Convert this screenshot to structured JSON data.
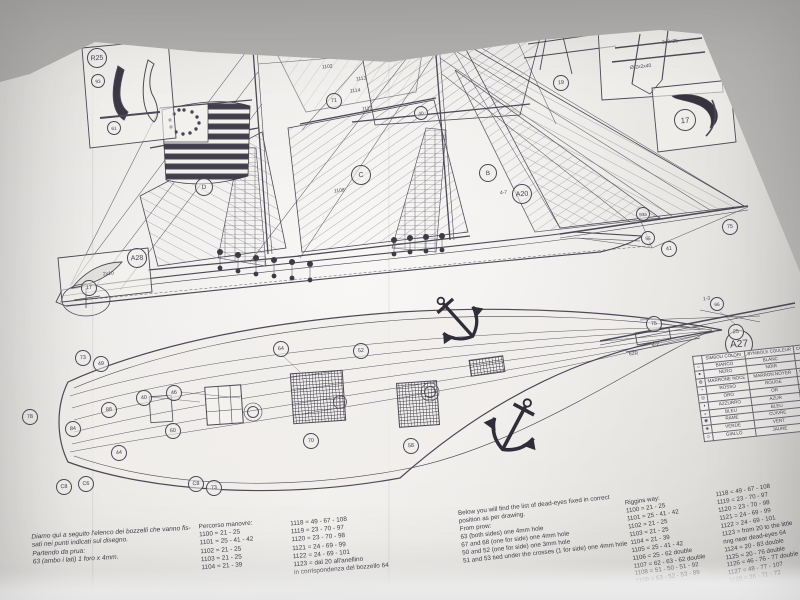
{
  "meta": {
    "description": "Photograph of a ship model construction plan sheet (sail plan, deck plan, rigging lists, colour symbol table)"
  },
  "colors": {
    "backdrop": "#b2b0ae",
    "paper": "#edebe8",
    "ink": "#4b4a56",
    "dark_fill": "#35343f"
  },
  "drawing_labels": {
    "circled": [
      {
        "t": "R25",
        "x": 96,
        "y": 57,
        "r": 9
      },
      {
        "t": "93",
        "x": 97,
        "y": 80,
        "r": 6
      },
      {
        "t": "61",
        "x": 113,
        "y": 127,
        "r": 6
      },
      {
        "t": "19",
        "x": 560,
        "y": 82,
        "r": 7
      },
      {
        "t": "17",
        "x": 684,
        "y": 119,
        "r": 10
      },
      {
        "t": "F",
        "x": 277,
        "y": 38,
        "r": 7
      },
      {
        "t": "B",
        "x": 487,
        "y": 172,
        "r": 8
      },
      {
        "t": "C",
        "x": 360,
        "y": 174,
        "r": 9
      },
      {
        "t": "D",
        "x": 203,
        "y": 186,
        "r": 8
      },
      {
        "t": "A20",
        "x": 521,
        "y": 193,
        "r": 9
      },
      {
        "t": "A27",
        "x": 738,
        "y": 343,
        "r": 13
      },
      {
        "t": "A28",
        "x": 136,
        "y": 257,
        "r": 9
      },
      {
        "t": "17",
        "x": 88,
        "y": 287,
        "r": 7
      },
      {
        "t": "25",
        "x": 735,
        "y": 331,
        "r": 7
      },
      {
        "t": "75",
        "x": 653,
        "y": 323,
        "r": 7
      },
      {
        "t": "66",
        "x": 716,
        "y": 303,
        "r": 6
      },
      {
        "t": "75",
        "x": 729,
        "y": 226,
        "r": 7
      },
      {
        "t": "41",
        "x": 668,
        "y": 248,
        "r": 7
      },
      {
        "t": "55",
        "x": 647,
        "y": 237,
        "r": 6
      },
      {
        "t": "93a",
        "x": 642,
        "y": 213,
        "r": 6
      },
      {
        "t": "71",
        "x": 333,
        "y": 100,
        "r": 7
      },
      {
        "t": "40",
        "x": 420,
        "y": 112,
        "r": 6
      },
      {
        "t": "73",
        "x": 82,
        "y": 357,
        "r": 7
      },
      {
        "t": "49",
        "x": 100,
        "y": 363,
        "r": 7
      },
      {
        "t": "40",
        "x": 143,
        "y": 397,
        "r": 7
      },
      {
        "t": "46",
        "x": 173,
        "y": 392,
        "r": 7
      },
      {
        "t": "88",
        "x": 108,
        "y": 409,
        "r": 7
      },
      {
        "t": "84",
        "x": 72,
        "y": 428,
        "r": 7
      },
      {
        "t": "60",
        "x": 172,
        "y": 430,
        "r": 7
      },
      {
        "t": "44",
        "x": 118,
        "y": 452,
        "r": 7
      },
      {
        "t": "64",
        "x": 280,
        "y": 348,
        "r": 7
      },
      {
        "t": "70",
        "x": 310,
        "y": 440,
        "r": 7
      },
      {
        "t": "52",
        "x": 360,
        "y": 350,
        "r": 7
      },
      {
        "t": "58",
        "x": 410,
        "y": 445,
        "r": 7
      },
      {
        "t": "78",
        "x": 29,
        "y": 416,
        "r": 7
      },
      {
        "t": "C8",
        "x": 63,
        "y": 486,
        "r": 7
      },
      {
        "t": "C6",
        "x": 85,
        "y": 483,
        "r": 7
      },
      {
        "t": "C8",
        "x": 195,
        "y": 483,
        "r": 7
      },
      {
        "t": "73",
        "x": 213,
        "y": 487,
        "r": 7
      }
    ],
    "plain": [
      {
        "t": "2x3x25",
        "x": 662,
        "y": 39
      },
      {
        "t": "Ø 2x2x40",
        "x": 630,
        "y": 64
      },
      {
        "t": "2x10",
        "x": 103,
        "y": 271
      },
      {
        "t": "1101",
        "x": 296,
        "y": 50
      },
      {
        "t": "1102",
        "x": 322,
        "y": 64
      },
      {
        "t": "1113",
        "x": 356,
        "y": 76
      },
      {
        "t": "1114",
        "x": 350,
        "y": 88
      },
      {
        "t": "1110",
        "x": 362,
        "y": 106
      },
      {
        "t": "1108",
        "x": 334,
        "y": 188
      },
      {
        "t": "4-7",
        "x": 500,
        "y": 190
      },
      {
        "t": "1-3",
        "x": 703,
        "y": 296
      },
      {
        "t": "62R",
        "x": 629,
        "y": 351
      },
      {
        "t": "4-2",
        "x": 652,
        "y": 342
      }
    ]
  },
  "color_table": {
    "headers": [
      "SIMBOLI COLORI",
      "SYMBOLE COULEUR",
      "COLOUR SYMBOL",
      "SYMBOL FARBE"
    ],
    "rows": [
      {
        "sym": "○",
        "cells": [
          "BIANCO",
          "BLANC",
          "WHITE",
          "WEISS"
        ]
      },
      {
        "sym": "●",
        "cells": [
          "NERO",
          "NOIR",
          "BLACK",
          "SCHWARZ"
        ]
      },
      {
        "sym": "◍",
        "cells": [
          "MARRONE NOCE",
          "MARRON NOYER",
          "BROWN WALNUT",
          "BRAUN NUSS"
        ]
      },
      {
        "sym": "◔",
        "cells": [
          "ROSSO",
          "ROUGE",
          "RED",
          "ROT"
        ]
      },
      {
        "sym": "◎",
        "cells": [
          "ORO",
          "OR",
          "GOLD",
          "GOLD"
        ]
      },
      {
        "sym": "◑",
        "cells": [
          "AZZURRO",
          "AZUR",
          "LIGHTBLUE",
          "HELLBLAU"
        ]
      },
      {
        "sym": "◒",
        "cells": [
          "BLEU",
          "BLEU",
          "BLUE",
          "BLAU"
        ]
      },
      {
        "sym": "◉",
        "cells": [
          "RAME",
          "CUIVRE",
          "COPPER",
          "KUPFER"
        ]
      },
      {
        "sym": "◈",
        "cells": [
          "VERDE",
          "VERT",
          "GREEN",
          "GRÜN"
        ]
      },
      {
        "sym": "◇",
        "cells": [
          "GIALLO",
          "JAUNE",
          "YELLOW",
          "GELB"
        ]
      }
    ]
  },
  "bottom_texts": {
    "italian_paragraph": [
      "Diamo qui a seguito l'elenco dei bozzelli che vanno fis-",
      "sati nei punti indicati sul disegno.",
      "Partendo da prua:",
      "63 (ambo i lati) 1 foro x 4mm."
    ],
    "percorso_title": "Percorso manovre:",
    "percorso_lines": [
      "1100 = 21 - 25",
      "1101 = 25 - 41 - 42",
      "1102 = 21 - 25",
      "1103 = 21 - 25",
      "1104 = 21 - 39"
    ],
    "elenco_lines": [
      "1118 = 49 - 67 - 108",
      "1119 = 23 - 70 - 97",
      "1120 = 23 - 70 - 98",
      "1121 = 24 - 69 - 99",
      "1122 = 24 - 69 - 101",
      "1123 = dal 20 all'anellino",
      "in corrispondenza del bozzello 64"
    ],
    "english_paragraph": [
      "Below you will find the list of dead-eyes fixed in correct",
      "position as per drawing.",
      "From prow:",
      "63 (both sides) one 4mm hole",
      "67 and 68 (one for side) one 4mm hole",
      "50 and 52 (one for side) one 3mm hole",
      "51 and 53 tied under the crosses (1 for side) one 4mm hole"
    ],
    "rigging_title": "Riggins way:",
    "rigging_lines": [
      "1100 = 21 - 25",
      "1101 = 25 - 41 - 42",
      "1102 = 21 - 25",
      "1103 = 21 - 25",
      "1104 = 21 - 39",
      "1105 = 25 - 41 - 42",
      "1106 = 25 - 62 double",
      "1107 = 62 - 63 - 62 double",
      "1108 = 51 - 50 - 51 - 92",
      "1109 = 53 - 52 - 53 - 89"
    ],
    "rigging_lines2": [
      "1118 = 49 - 67 - 108",
      "1119 = 23 - 70 - 97",
      "1120 = 23 - 70 - 98",
      "1121 = 24 - 69 - 99",
      "1122 = 24 - 69 - 101",
      "1123 = from 20 to the little",
      "ring near dead-eyes 64",
      "1124 = 20 - 83 double",
      "1125 = 20 - 76 double",
      "1126 = 46 - 76 - 77 double",
      "1127 = 48 - 77 - 107",
      "1128 = 26 - 71 - 72"
    ]
  }
}
